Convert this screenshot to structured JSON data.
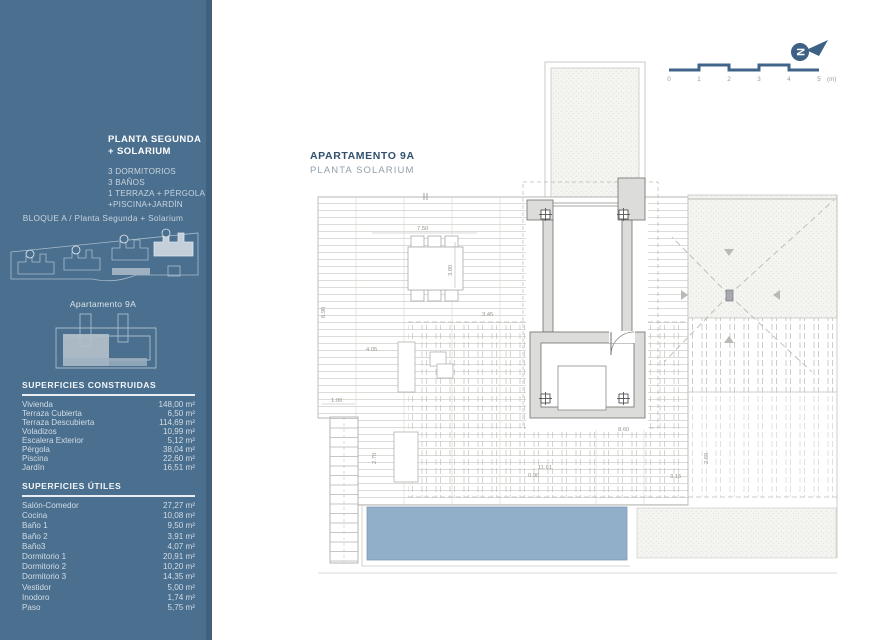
{
  "sidebar": {
    "plan_title": "PLANTA SEGUNDA + SOLARIUM",
    "features": [
      "3 DORMITORIOS",
      "3 BAÑOS",
      "1 TERRAZA + PÉRGOLA",
      "+PISCINA+JARDÍN"
    ],
    "block_label": "BLOQUE A / Planta Segunda + Solarium",
    "apartment_label": "Apartamento 9A",
    "constructed": {
      "title": "SUPERFICIES CONSTRUIDAS",
      "rows": [
        {
          "label": "Vivienda",
          "value": "148,00 m²"
        },
        {
          "label": "Terraza Cubierta",
          "value": "6,50 m²"
        },
        {
          "label": "Terraza Descubierta",
          "value": "114,69 m²"
        },
        {
          "label": "Voladizos",
          "value": "10,99 m²"
        },
        {
          "label": "Escalera Exterior",
          "value": "5,12 m²"
        },
        {
          "label": "Pérgola",
          "value": "38,04 m²"
        },
        {
          "label": "Piscina",
          "value": "22,60 m²"
        },
        {
          "label": "Jardín",
          "value": "16,51 m²"
        }
      ]
    },
    "useful": {
      "title": "SUPERFICIES ÚTILES",
      "rows": [
        {
          "label": "Salón-Comedor",
          "value": "27,27 m²"
        },
        {
          "label": "Cocina",
          "value": "10,08 m²"
        },
        {
          "label": "Baño 1",
          "value": "9,50 m²"
        },
        {
          "label": "Baño 2",
          "value": "3,91 m²"
        },
        {
          "label": "Baño3",
          "value": "4,07 m²"
        },
        {
          "label": "Dormitorio 1",
          "value": "20,91 m²"
        },
        {
          "label": "Dormitorio 2",
          "value": "10,20 m²"
        },
        {
          "label": "Dormitorio 3",
          "value": "14,35 m²"
        },
        {
          "label": "Vestidor",
          "value": "5,00 m²"
        },
        {
          "label": "Inodoro",
          "value": "1,74 m²"
        },
        {
          "label": "Paso",
          "value": "5,75 m²"
        }
      ]
    }
  },
  "main": {
    "title": "APARTAMENTO 9A",
    "subtitle": "PLANTA SOLARIUM",
    "scale": {
      "ticks": [
        "0",
        "1",
        "2",
        "3",
        "4",
        "5"
      ],
      "unit": "(m)"
    },
    "plan": {
      "dims": {
        "d750": "7.50",
        "d380": "3.80",
        "d690": "6.90",
        "d345": "3.45",
        "d405": "4.05",
        "d100": "1.00",
        "d270": "2.70",
        "d1161": "11.61",
        "d090": "0.90",
        "d860": "8.60",
        "d260": "2.60",
        "d315": "3.15"
      }
    }
  },
  "colors": {
    "sidebar": "#4a6f8f",
    "accent_dark": "#3e6285",
    "pool": "#92afc9"
  }
}
